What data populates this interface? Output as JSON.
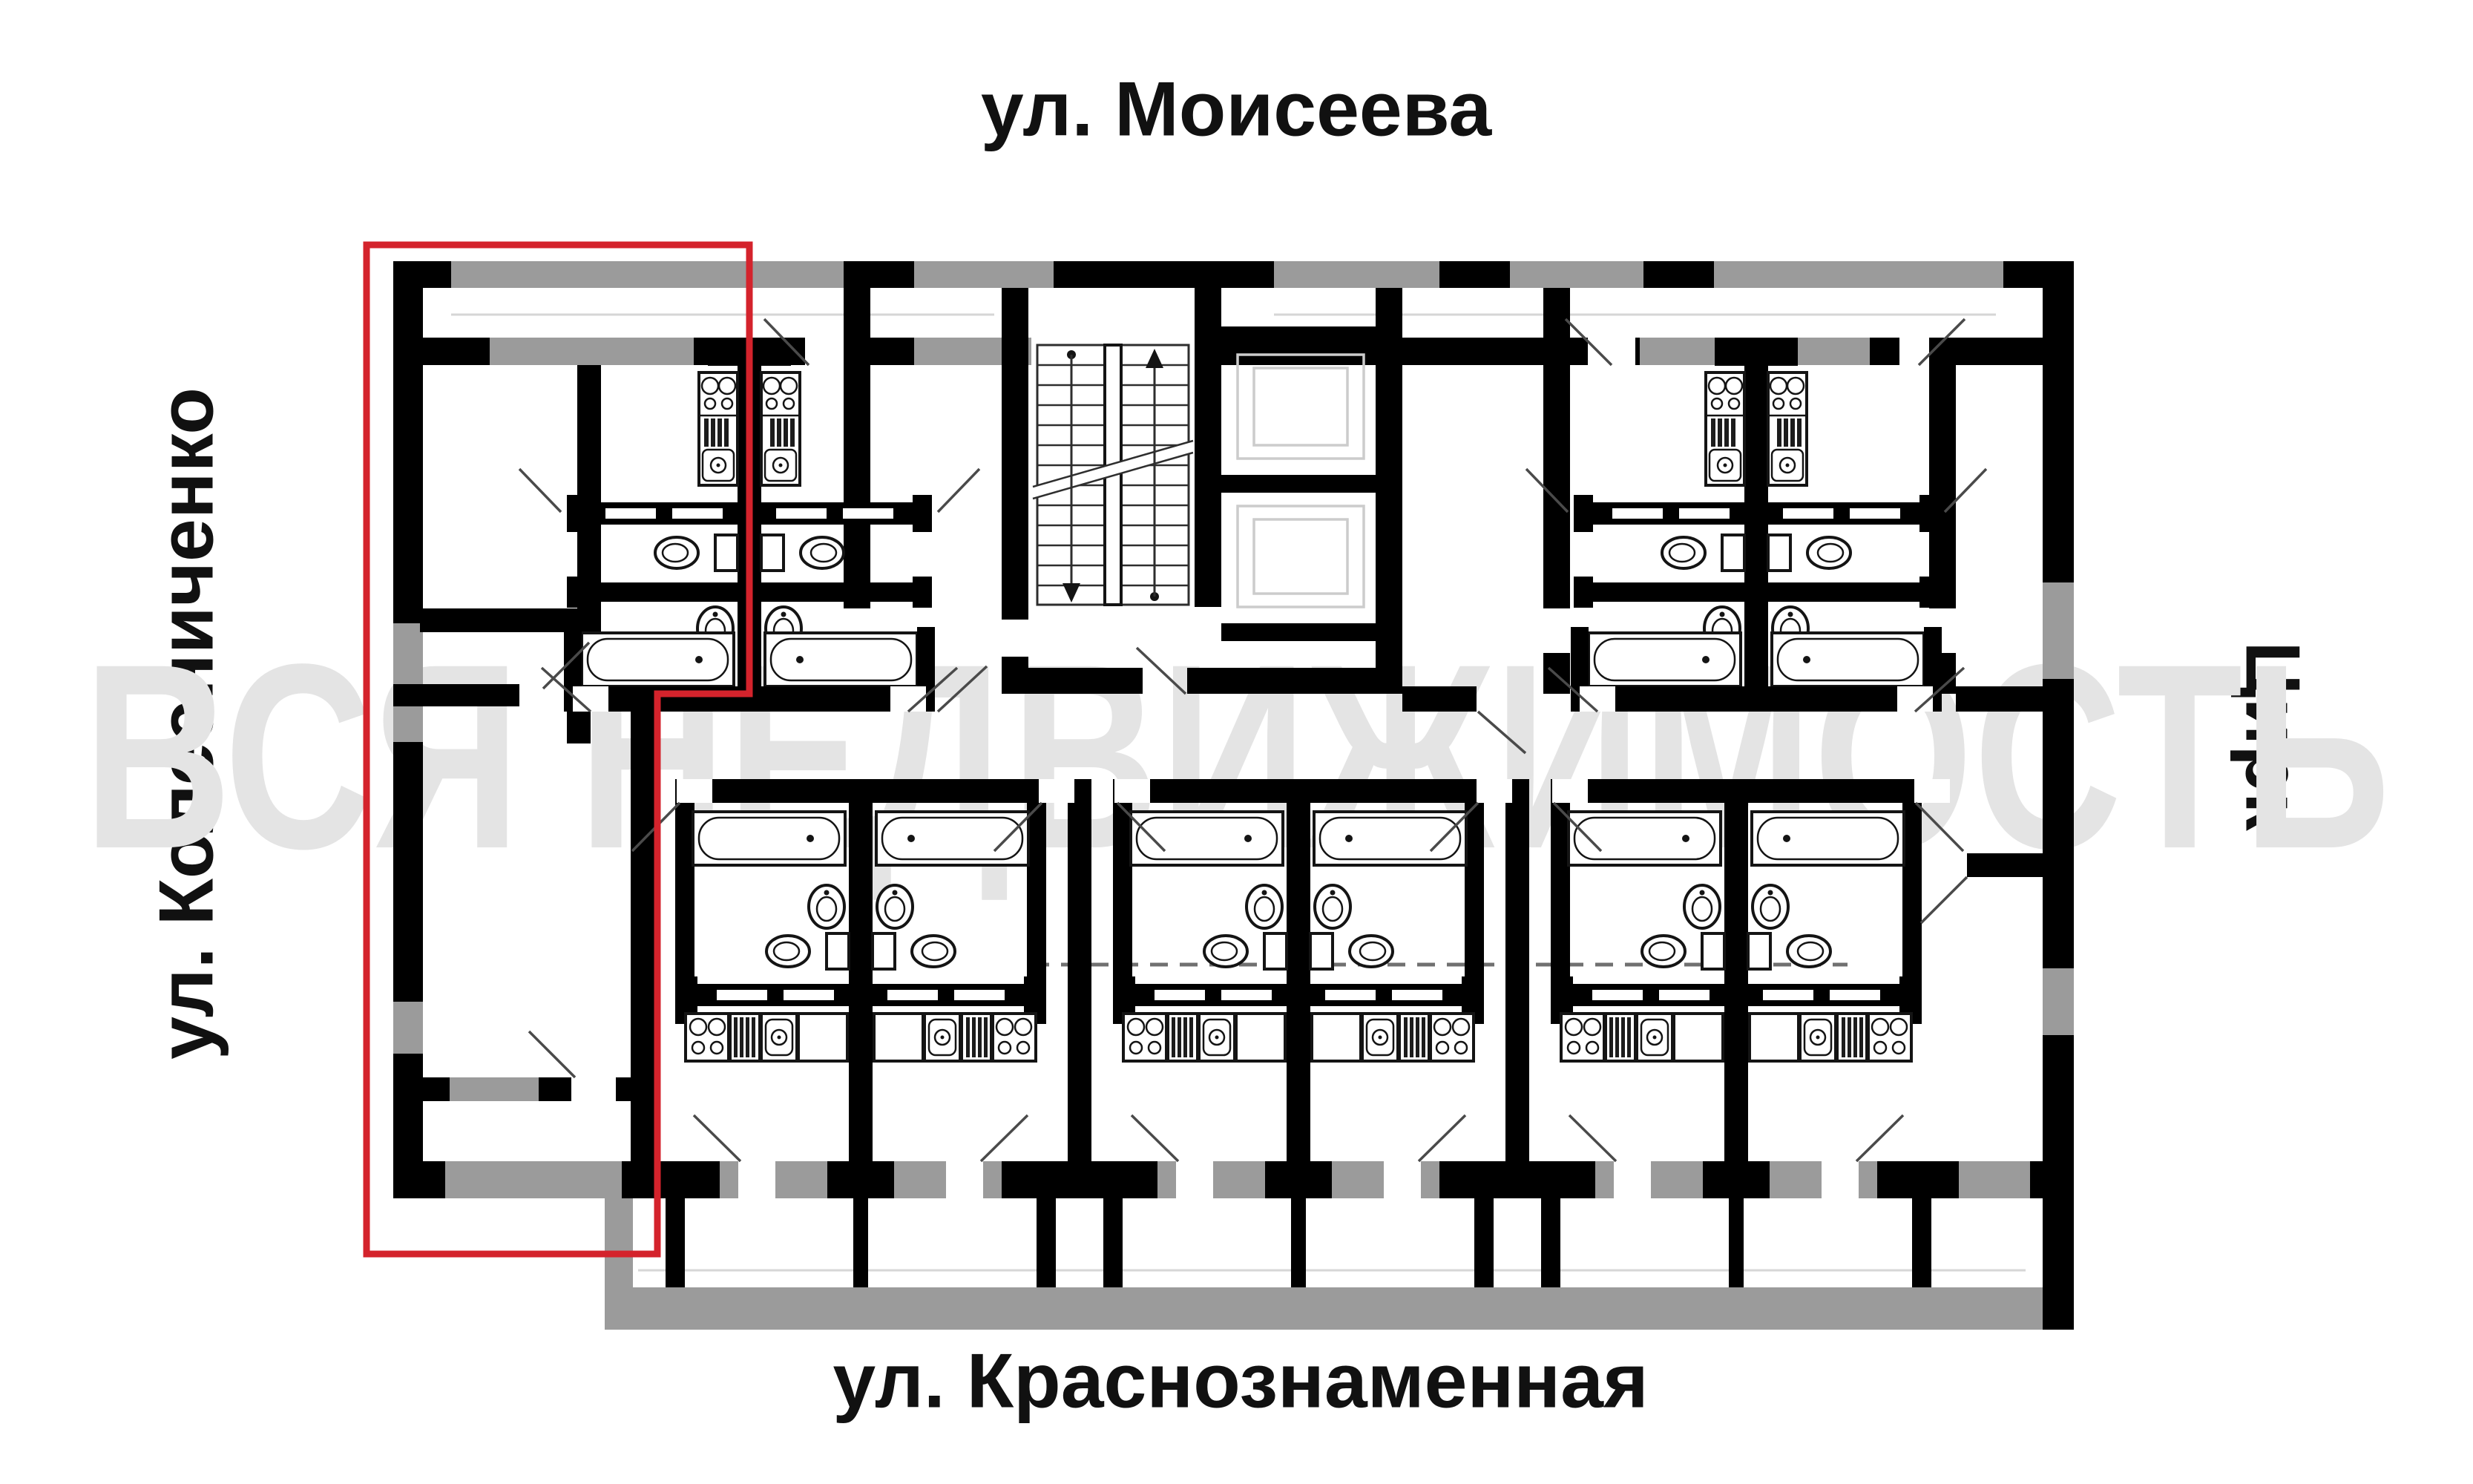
{
  "labels": {
    "street_top": "ул. Моисеева",
    "street_bottom": "ул. Краснознаменная",
    "street_left": "ул. Колесниченко",
    "street_right": "Цирк"
  },
  "watermark": {
    "text": "ВСЯ НЕДВИЖИМОСТЬ"
  },
  "colors": {
    "wall": "#000000",
    "band": "#9b9b9b",
    "watermark": "#e4e4e4",
    "highlight": "#d4232c",
    "text": "#111111",
    "background": "#ffffff"
  }
}
